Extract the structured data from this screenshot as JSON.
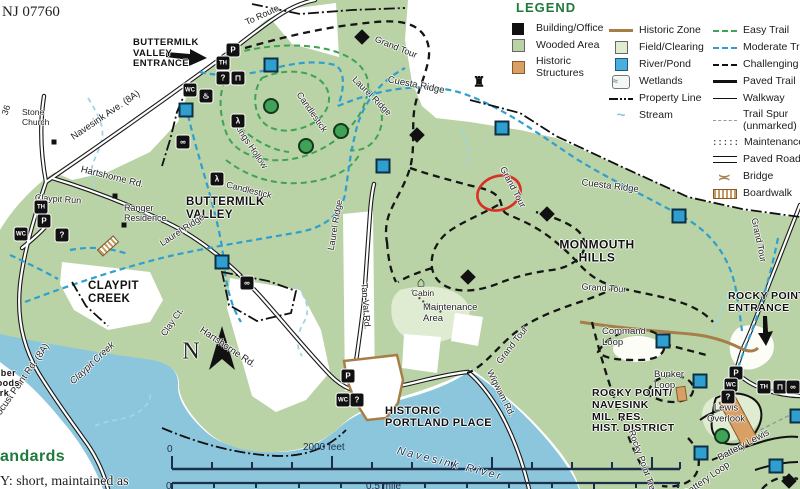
{
  "colors": {
    "park_green": "#b9d3a6",
    "field_green": "#dfecd2",
    "water_blue": "#8cc6dc",
    "easy": "#3fa257",
    "moderate": "#2f9fd0",
    "stream": "#9fd6e6",
    "historic_tan": "#d9a066",
    "historic_line": "#a87e48",
    "annotation_red": "#d93025",
    "legend_green": "#1e7a3a",
    "scale": "#1c2f4a"
  },
  "legend": {
    "title": "LEGEND",
    "col1": [
      {
        "label": "Building/Office"
      },
      {
        "label": "Wooded Area"
      },
      {
        "label": "Historic\nStructures"
      }
    ],
    "col2": [
      {
        "label": "Historic Zone"
      },
      {
        "label": "Field/Clearing"
      },
      {
        "label": "River/Pond"
      },
      {
        "label": "Wetlands",
        "glyph": "≈"
      },
      {
        "label": "Property Line"
      },
      {
        "label": "Stream",
        "glyph": "~"
      }
    ],
    "col3": [
      {
        "label": "Easy Trail"
      },
      {
        "label": "Moderate Trail"
      },
      {
        "label": "Challenging Trail"
      },
      {
        "label": "Paved Trail"
      },
      {
        "label": "Walkway"
      },
      {
        "label": "Trail Spur\n(unmarked)"
      },
      {
        "label": "Maintenance",
        "glyph": ":::::"
      },
      {
        "label": "Paved Road"
      },
      {
        "label": "Bridge",
        "glyph": ")("
      },
      {
        "label": "Boardwalk"
      }
    ]
  },
  "scale_bar": {
    "feet_zero": "0",
    "feet_label": "2000 feet",
    "mile_zero": "0",
    "mile_label": "0.5 mile"
  },
  "map": {
    "labels": [
      {
        "n": "zip-code",
        "t": "NJ 07760",
        "x": 2,
        "y": 4,
        "f": 15,
        "c": "serif tl"
      },
      {
        "n": "buttermilk-valley-entrance-label",
        "t": "BUTTERMILK\nVALLEY\nENTRANCE",
        "x": 133,
        "y": 38,
        "f": 9.5,
        "c": "bold tl"
      },
      {
        "n": "to-route-label",
        "t": "To Route",
        "x": 262,
        "y": 15,
        "r": -25,
        "f": 9
      },
      {
        "n": "route-36-label",
        "t": "36",
        "x": 6,
        "y": 110,
        "r": -72,
        "f": 9
      },
      {
        "n": "navesink-ave-label",
        "t": "Navesink Ave. (8A)",
        "x": 106,
        "y": 116,
        "r": -34,
        "f": 9.5
      },
      {
        "n": "stone-church-label",
        "t": "Stone\nChurch",
        "x": 22,
        "y": 108,
        "f": 8.5,
        "c": "tl"
      },
      {
        "n": "hartshorne-rd-label-1",
        "t": "Hartshorne Rd.",
        "x": 112,
        "y": 178,
        "r": 14,
        "f": 9.5
      },
      {
        "n": "claypit-run-label",
        "t": "Claypit Run",
        "x": 58,
        "y": 199,
        "r": 4,
        "f": 9
      },
      {
        "n": "ranger-residence-label",
        "t": "Ranger\nResidence",
        "x": 124,
        "y": 203,
        "f": 9,
        "c": "tl"
      },
      {
        "n": "buttermilk-valley-label",
        "t": "BUTTERMILK\nVALLEY",
        "x": 186,
        "y": 196,
        "f": 11.5,
        "c": "bold tl"
      },
      {
        "n": "laurel-ridge-label-1",
        "t": "Laurel Ridge",
        "x": 182,
        "y": 230,
        "r": -33,
        "f": 9
      },
      {
        "n": "laurel-ridge-label-2",
        "t": "Laurel Ridge",
        "x": 335,
        "y": 225,
        "r": -80,
        "f": 9
      },
      {
        "n": "laurel-ridge-label-3",
        "t": "Laurel Ridge",
        "x": 372,
        "y": 96,
        "r": 45,
        "f": 9
      },
      {
        "n": "kings-hollow-label",
        "t": "Kings Hollow",
        "x": 251,
        "y": 146,
        "r": 56,
        "f": 9
      },
      {
        "n": "candlestick-label-1",
        "t": "Candlestick",
        "x": 312,
        "y": 112,
        "r": 55,
        "f": 9
      },
      {
        "n": "candlestick-label-2",
        "t": "Candlestick",
        "x": 249,
        "y": 190,
        "r": 14,
        "f": 9
      },
      {
        "n": "grand-tour-label-1",
        "t": "Grand Tour",
        "x": 396,
        "y": 47,
        "r": 22,
        "f": 9
      },
      {
        "n": "grand-tour-label-2",
        "t": "Grand Tour",
        "x": 513,
        "y": 187,
        "r": 62,
        "f": 9
      },
      {
        "n": "grand-tour-label-3",
        "t": "Grand Tour",
        "x": 604,
        "y": 288,
        "r": 4,
        "f": 9
      },
      {
        "n": "grand-tour-label-4",
        "t": "Grand Tour",
        "x": 512,
        "y": 345,
        "r": -52,
        "f": 9
      },
      {
        "n": "grand-tour-label-5",
        "t": "Grand Tour",
        "x": 759,
        "y": 240,
        "r": 78,
        "f": 9
      },
      {
        "n": "cuesta-ridge-label-1",
        "t": "Cuesta Ridge",
        "x": 416,
        "y": 86,
        "r": 11,
        "f": 9.5
      },
      {
        "n": "cuesta-ridge-label-2",
        "t": "Cuesta Ridge",
        "x": 610,
        "y": 187,
        "r": 7,
        "f": 9.5
      },
      {
        "n": "monmouth-hills-label",
        "t": "MONMOUTH\nHILLS",
        "x": 597,
        "y": 252,
        "f": 12,
        "c": "bold"
      },
      {
        "n": "maintenance-area-label",
        "t": "Maintenance\nArea",
        "x": 423,
        "y": 303,
        "f": 9.5,
        "c": "tl"
      },
      {
        "n": "cabin-label",
        "t": "Cabin",
        "x": 423,
        "y": 294,
        "f": 8.5
      },
      {
        "n": "tan-vat-rd-label",
        "t": "Tan Vat Rd.",
        "x": 366,
        "y": 306,
        "r": 86,
        "f": 9
      },
      {
        "n": "clay-ct-label",
        "t": "Clay Ct.",
        "x": 172,
        "y": 322,
        "r": -55,
        "f": 9
      },
      {
        "n": "hartshorne-rd-label-2",
        "t": "Hartshorne Rd.",
        "x": 227,
        "y": 348,
        "r": 34,
        "f": 9.5
      },
      {
        "n": "claypit-creek-area-label",
        "t": "CLAYPIT\nCREEK",
        "x": 88,
        "y": 280,
        "f": 11.5,
        "c": "bold tl"
      },
      {
        "n": "claypit-creek-water-label",
        "t": "Claypit Creek",
        "x": 93,
        "y": 364,
        "r": -43,
        "f": 9.5,
        "c": "italic"
      },
      {
        "n": "locust-point-rd-label",
        "t": "Locust Point Rd. (8A)",
        "x": 22,
        "y": 382,
        "r": -55,
        "f": 9.5
      },
      {
        "n": "huber-woods-park-label",
        "t": "Huber\nWoods\nPark",
        "x": -12,
        "y": 368,
        "f": 9,
        "c": "bold tl"
      },
      {
        "n": "historic-portland-place-label",
        "t": "HISTORIC\nPORTLAND PLACE",
        "x": 385,
        "y": 405,
        "f": 11,
        "c": "bold tl"
      },
      {
        "n": "navesink-river-label",
        "t": "Navesink River",
        "x": 450,
        "y": 464,
        "r": 14,
        "f": 11,
        "c": "italic spread"
      },
      {
        "n": "wigwam-rd-label",
        "t": "Wigwam Rd.",
        "x": 501,
        "y": 393,
        "r": 63,
        "f": 9
      },
      {
        "n": "rocky-point-entrance-label",
        "t": "ROCKY POINT\nENTRANCE",
        "x": 728,
        "y": 291,
        "f": 10.5,
        "c": "bold tl"
      },
      {
        "n": "command-loop-label",
        "t": "Command\nLoop",
        "x": 602,
        "y": 327,
        "f": 9.5,
        "c": "tl"
      },
      {
        "n": "bunker-loop-label",
        "t": "Bunker\nLoop",
        "x": 654,
        "y": 370,
        "f": 9.5,
        "c": "tl"
      },
      {
        "n": "rocky-point-district-label",
        "t": "ROCKY POINT/\nNAVESINK\nMIL. RES.\nHIST. DISTRICT",
        "x": 592,
        "y": 388,
        "f": 10.5,
        "c": "bold tl"
      },
      {
        "n": "lewis-overlook-label",
        "t": "Lewis\nOverlook",
        "x": 726,
        "y": 414,
        "f": 9.5
      },
      {
        "n": "battery-lewis-label",
        "t": "Battery Lewis",
        "x": 744,
        "y": 446,
        "r": -28,
        "f": 9.5
      },
      {
        "n": "battery-loop-label",
        "t": "Battery Loop",
        "x": 707,
        "y": 480,
        "r": -35,
        "f": 9.5
      },
      {
        "n": "rocky-point-trail-label",
        "t": "Rocky Point Trail",
        "x": 643,
        "y": 462,
        "r": 70,
        "f": 9
      },
      {
        "n": "north-label",
        "t": "N",
        "x": 191,
        "y": 352,
        "f": 24,
        "c": "serif"
      },
      {
        "n": "trail-standards-heading-fragment",
        "t": "andards",
        "x": 0,
        "y": 448,
        "f": 16,
        "c": "bold tl green-text"
      },
      {
        "n": "trail-standards-body-fragment",
        "t": "Y: short, maintained as",
        "x": 0,
        "y": 474,
        "f": 14,
        "c": "serif tl"
      }
    ],
    "icons": [
      {
        "n": "parking-icon",
        "g": "P",
        "x": 233,
        "y": 50
      },
      {
        "n": "trailhead-icon",
        "g": "TH",
        "x": 223,
        "y": 63,
        "c": "sm"
      },
      {
        "n": "info-icon",
        "g": "?",
        "x": 223,
        "y": 78
      },
      {
        "n": "picnic-icon",
        "g": "⊓",
        "x": 238,
        "y": 78
      },
      {
        "n": "restroom-icon",
        "g": "WC",
        "x": 190,
        "y": 90,
        "c": "sm"
      },
      {
        "n": "drinking-water-icon",
        "g": "♨",
        "x": 206,
        "y": 96
      },
      {
        "n": "hiker-icon",
        "g": "λ",
        "x": 238,
        "y": 121
      },
      {
        "n": "hiker-icon",
        "g": "λ",
        "x": 217,
        "y": 179
      },
      {
        "n": "binoculars-icon",
        "g": "∞",
        "x": 183,
        "y": 142
      },
      {
        "n": "binoculars-icon",
        "g": "∞",
        "x": 247,
        "y": 283
      },
      {
        "n": "trailhead-icon",
        "g": "TH",
        "x": 41,
        "y": 207,
        "c": "sm"
      },
      {
        "n": "parking-icon",
        "g": "P",
        "x": 44,
        "y": 221
      },
      {
        "n": "restroom-icon",
        "g": "WC",
        "x": 21,
        "y": 234,
        "c": "sm"
      },
      {
        "n": "info-icon",
        "g": "?",
        "x": 62,
        "y": 235
      },
      {
        "n": "parking-icon",
        "g": "P",
        "x": 348,
        "y": 376
      },
      {
        "n": "restroom-icon",
        "g": "WC",
        "x": 343,
        "y": 400,
        "c": "sm"
      },
      {
        "n": "info-icon",
        "g": "?",
        "x": 357,
        "y": 400
      },
      {
        "n": "parking-icon",
        "g": "P",
        "x": 736,
        "y": 373
      },
      {
        "n": "restroom-icon",
        "g": "WC",
        "x": 731,
        "y": 385,
        "c": "sm"
      },
      {
        "n": "info-icon",
        "g": "?",
        "x": 728,
        "y": 397
      },
      {
        "n": "trailhead-icon",
        "g": "TH",
        "x": 764,
        "y": 387,
        "c": "sm"
      },
      {
        "n": "picnic-icon",
        "g": "⊓",
        "x": 780,
        "y": 387
      },
      {
        "n": "binoculars-icon",
        "g": "∞",
        "x": 793,
        "y": 387
      },
      {
        "n": "cabin-icon",
        "g": "⌂",
        "x": 421,
        "y": 281,
        "c": "plain"
      },
      {
        "n": "tower-icon",
        "g": "♜",
        "x": 479,
        "y": 82,
        "c": "plain"
      },
      {
        "n": "boardwalk-icon",
        "g": "",
        "x": 108,
        "y": 246,
        "c": "bw"
      }
    ],
    "markers": [
      {
        "type": "easy",
        "x": 271,
        "y": 106
      },
      {
        "type": "easy",
        "x": 306,
        "y": 146
      },
      {
        "type": "easy",
        "x": 341,
        "y": 131
      },
      {
        "type": "easy",
        "x": 722,
        "y": 436
      },
      {
        "type": "moderate",
        "x": 271,
        "y": 65
      },
      {
        "type": "moderate",
        "x": 186,
        "y": 110
      },
      {
        "type": "moderate",
        "x": 222,
        "y": 262
      },
      {
        "type": "moderate",
        "x": 383,
        "y": 166
      },
      {
        "type": "moderate",
        "x": 502,
        "y": 128
      },
      {
        "type": "moderate",
        "x": 679,
        "y": 216
      },
      {
        "type": "moderate",
        "x": 663,
        "y": 341
      },
      {
        "type": "moderate",
        "x": 700,
        "y": 381
      },
      {
        "type": "moderate",
        "x": 701,
        "y": 453
      },
      {
        "type": "moderate",
        "x": 776,
        "y": 466
      },
      {
        "type": "moderate",
        "x": 797,
        "y": 416
      },
      {
        "type": "challenging",
        "x": 362,
        "y": 37
      },
      {
        "type": "challenging",
        "x": 417,
        "y": 135
      },
      {
        "type": "challenging",
        "x": 547,
        "y": 214
      },
      {
        "type": "challenging",
        "x": 468,
        "y": 277
      },
      {
        "type": "challenging",
        "x": 789,
        "y": 481
      },
      {
        "type": "building",
        "x": 115,
        "y": 196
      },
      {
        "type": "building",
        "x": 124,
        "y": 225
      },
      {
        "type": "building",
        "x": 54,
        "y": 142
      }
    ]
  }
}
